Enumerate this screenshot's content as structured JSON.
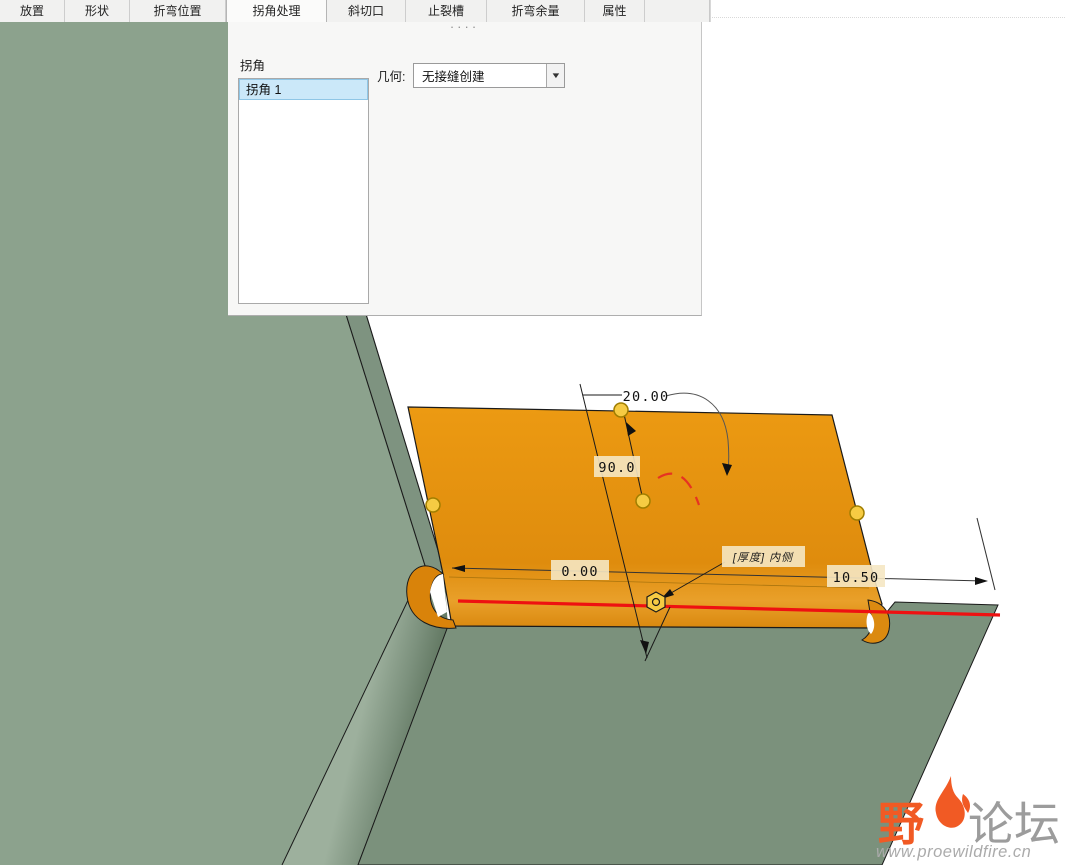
{
  "tabs": [
    "放置",
    "形状",
    "折弯位置",
    "拐角处理",
    "斜切口",
    "止裂槽",
    "折弯余量",
    "属性"
  ],
  "active_tab": "拐角处理",
  "panel": {
    "drag_dots": "····",
    "corner_section_label": "拐角",
    "corner_list": [
      "拐角 1"
    ],
    "selected_corner": "拐角 1",
    "geometry_label": "几何:",
    "geometry_value": "无接缝创建",
    "combo_arrow": "▼"
  },
  "viewport": {
    "dimensions": {
      "flange_length": "20.00",
      "bend_angle": "90.0",
      "offset": "0.00",
      "edge_distance": "10.50",
      "thickness_side_label": "[厚度]  内侧"
    },
    "colors": {
      "wall_green": "#8CA28D",
      "base_green": "#7B917C",
      "flange_orange": "#E8940C",
      "bend_line_red": "#EE1111",
      "dim_highlight_tan": "#F5E7C3",
      "handle_yellow": "#F6CB43",
      "watermark_orange": "#F15A24"
    }
  },
  "watermark": {
    "brand_primary": "野",
    "brand_secondary": "论坛",
    "url": "www.proewildfire.cn"
  }
}
